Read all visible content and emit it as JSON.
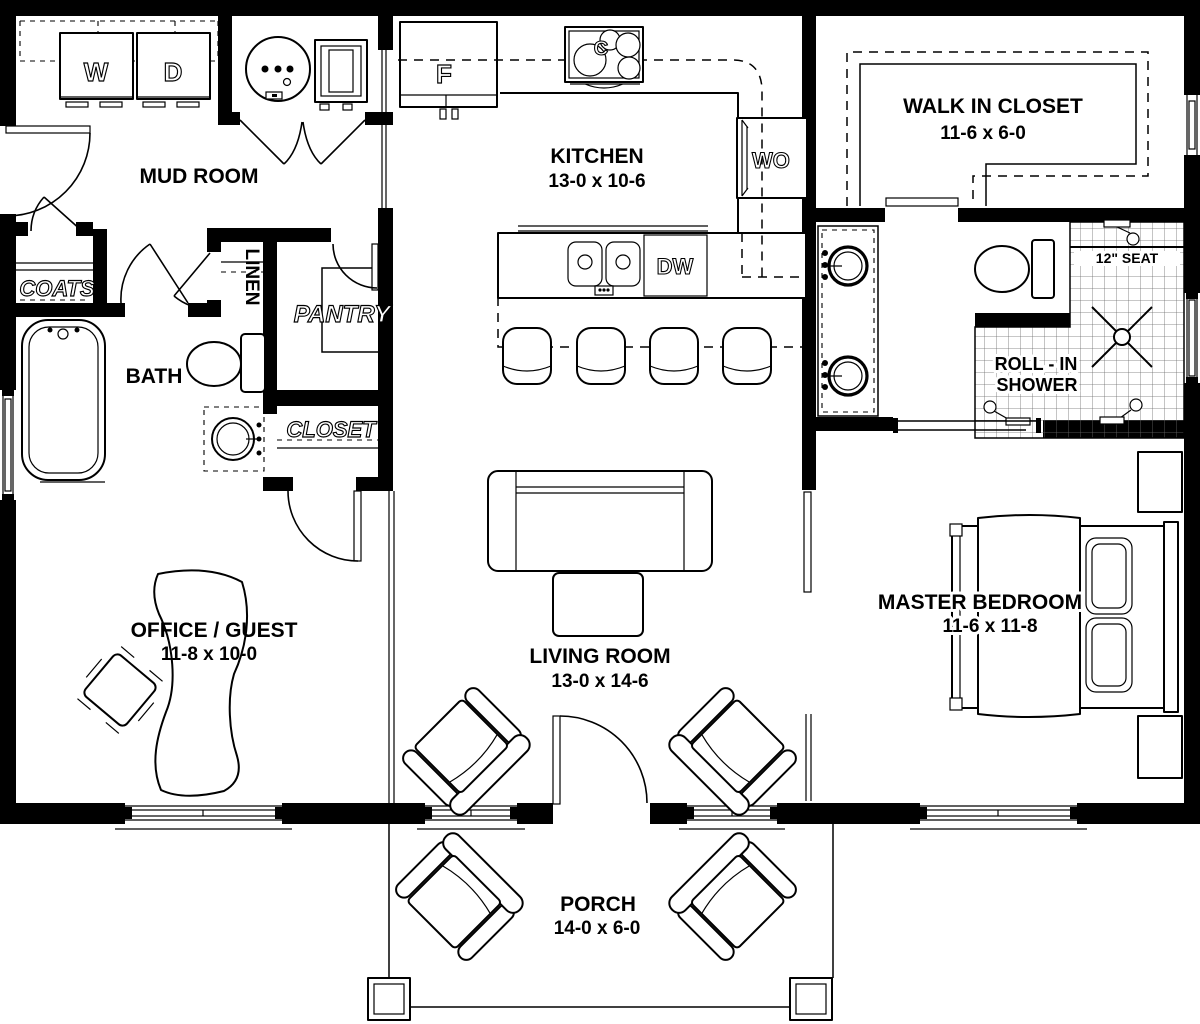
{
  "colors": {
    "line": "#000000",
    "background": "#ffffff"
  },
  "labels": {
    "mud_room": "MUD ROOM",
    "kitchen": "KITCHEN",
    "kitchen_dims": "13-0 x 10-6",
    "walk_in_closet": "WALK IN CLOSET",
    "walk_in_closet_dims": "11-6 x 6-0",
    "bath": "BATH",
    "office": "OFFICE / GUEST",
    "office_dims": "11-8 x 10-0",
    "living_room": "LIVING ROOM",
    "living_room_dims": "13-0 x 14-6",
    "master_bedroom": "MASTER BEDROOM",
    "master_bedroom_dims": "11-6 x 11-8",
    "porch": "PORCH",
    "porch_dims": "14-0 x 6-0",
    "coats": "COATS",
    "linen": "LINEN",
    "pantry": "PANTRY",
    "closet": "CLOSET",
    "washer": "W",
    "dryer": "D",
    "fridge": "F",
    "cooktop": "C",
    "wall_oven": "WO",
    "dishwasher": "DW",
    "shower_line1": "ROLL - IN",
    "shower_line2": "SHOWER",
    "shower_seat": "12\" SEAT"
  }
}
